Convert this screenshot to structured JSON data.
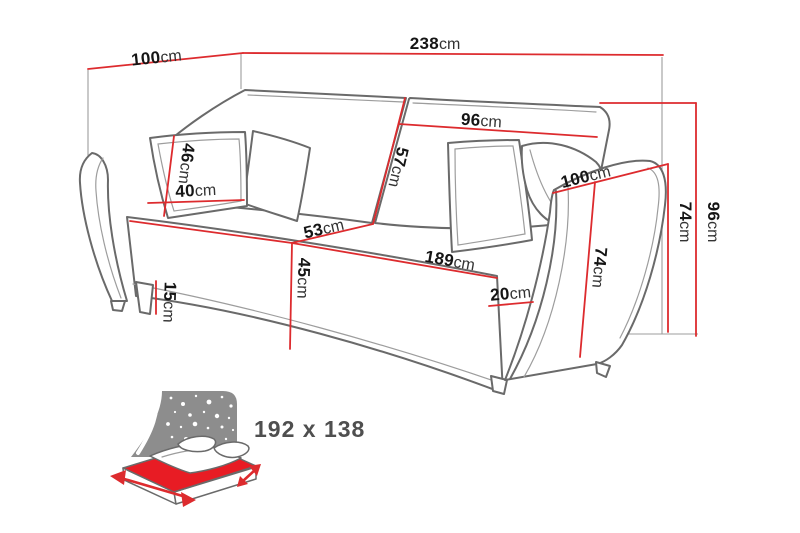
{
  "title": "Sofa bed dimensions diagram",
  "colors": {
    "dimension_line": "#dd2b2e",
    "outline": "#6a6a6a",
    "seam": "#9d9d9d",
    "text": "#151515",
    "unit": "#333333",
    "mattress": "#e81c24",
    "icon_panel": "#8d8d8d",
    "icon_text": "#4f4f4f",
    "background": "#ffffff"
  },
  "dims": {
    "back_top_depth": {
      "num": "100",
      "unit": "cm"
    },
    "total_width": {
      "num": "238",
      "unit": "cm"
    },
    "backrest_width": {
      "num": "96",
      "unit": "cm"
    },
    "backrest_height": {
      "num": "57",
      "unit": "cm"
    },
    "cushion_height": {
      "num": "46",
      "unit": "cm"
    },
    "cushion_width": {
      "num": "40",
      "unit": "cm"
    },
    "seat_depth": {
      "num": "53",
      "unit": "cm"
    },
    "seat_width": {
      "num": "189",
      "unit": "cm"
    },
    "seat_height": {
      "num": "45",
      "unit": "cm"
    },
    "base_clearance": {
      "num": "15",
      "unit": "cm"
    },
    "arm_depth": {
      "num": "100",
      "unit": "cm"
    },
    "arm_front_height": {
      "num": "74",
      "unit": "cm"
    },
    "arm_front_width": {
      "num": "20",
      "unit": "cm"
    },
    "side_height": {
      "num": "74",
      "unit": "cm"
    },
    "total_height": {
      "num": "96",
      "unit": "cm"
    }
  },
  "sleeping_area": {
    "label": "192 x 138"
  }
}
